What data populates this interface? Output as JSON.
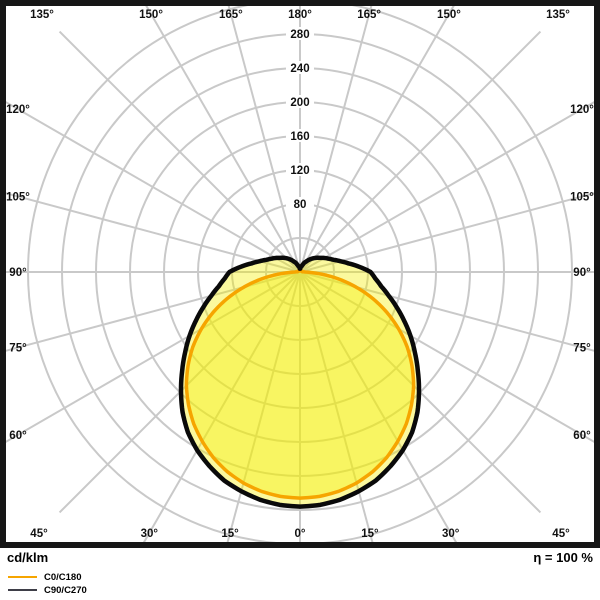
{
  "footer": {
    "unit_label": "cd/klm",
    "efficiency_label": "η = 100 %"
  },
  "chart_data": {
    "type": "polar",
    "subtype": "photometric-luminous-intensity-distribution",
    "unit": "cd/klm",
    "efficiency": "η = 100 %",
    "angle_step_deg": 15,
    "angle_labels": [
      "0°",
      "15°",
      "30°",
      "45°",
      "60°",
      "75°",
      "90°",
      "105°",
      "120°",
      "135°",
      "150°",
      "165°",
      "180°"
    ],
    "radial_tick_labels": [
      80,
      120,
      160,
      200,
      240,
      280
    ],
    "radial_circle_values": [
      40,
      80,
      120,
      160,
      200,
      240,
      280,
      320
    ],
    "radial_axis_max": 330,
    "grid_on": true,
    "legend_position": "bottom-left",
    "legend": [
      {
        "label": "C0/C180",
        "color": "#F6A500"
      },
      {
        "label": "C90/C270",
        "color": "#3E3E48"
      }
    ],
    "series": [
      {
        "name": "C0/C180",
        "color": "#F6A500",
        "points": [
          [
            0,
            266
          ],
          [
            5,
            265
          ],
          [
            10,
            262
          ],
          [
            15,
            257
          ],
          [
            20,
            250
          ],
          [
            25,
            241
          ],
          [
            30,
            230
          ],
          [
            35,
            218
          ],
          [
            40,
            204
          ],
          [
            45,
            189
          ],
          [
            50,
            172
          ],
          [
            55,
            154
          ],
          [
            60,
            134
          ],
          [
            65,
            113
          ],
          [
            70,
            91
          ],
          [
            75,
            68
          ],
          [
            80,
            45
          ],
          [
            84,
            27
          ],
          [
            87,
            14
          ],
          [
            90,
            6
          ],
          [
            95,
            3
          ],
          [
            105,
            2
          ],
          [
            120,
            2
          ],
          [
            135,
            2
          ],
          [
            150,
            2
          ],
          [
            160,
            3
          ],
          [
            168,
            4
          ],
          [
            173,
            5
          ],
          [
            177,
            6
          ],
          [
            180,
            7
          ]
        ]
      },
      {
        "name": "C90/C270",
        "color": "#0A0A0A",
        "points": [
          [
            0,
            276
          ],
          [
            5,
            275
          ],
          [
            10,
            272
          ],
          [
            15,
            267
          ],
          [
            20,
            261
          ],
          [
            25,
            252
          ],
          [
            30,
            242
          ],
          [
            35,
            230
          ],
          [
            40,
            215
          ],
          [
            45,
            198
          ],
          [
            50,
            181
          ],
          [
            55,
            165
          ],
          [
            60,
            150
          ],
          [
            65,
            135
          ],
          [
            70,
            121
          ],
          [
            75,
            108
          ],
          [
            80,
            97
          ],
          [
            85,
            89
          ],
          [
            90,
            83
          ],
          [
            95,
            70
          ],
          [
            100,
            58
          ],
          [
            105,
            49
          ],
          [
            110,
            42
          ],
          [
            115,
            37
          ],
          [
            120,
            33
          ],
          [
            125,
            29
          ],
          [
            130,
            26
          ],
          [
            135,
            23
          ],
          [
            140,
            20
          ],
          [
            145,
            17
          ],
          [
            150,
            14
          ],
          [
            155,
            12
          ],
          [
            160,
            9
          ],
          [
            165,
            7
          ],
          [
            170,
            6
          ],
          [
            174,
            5
          ],
          [
            177,
            4
          ],
          [
            180,
            4
          ]
        ]
      }
    ],
    "style": {
      "center_px": [
        300,
        272
      ],
      "px_per_unit": 0.85,
      "grid_color": "#C9C9C9",
      "grid_width": 2,
      "border_color": "#161616",
      "fill_color_rgba": "rgba(244,238,0,0.38)",
      "label_color": "#111111",
      "background": "#FFFFFF"
    }
  }
}
